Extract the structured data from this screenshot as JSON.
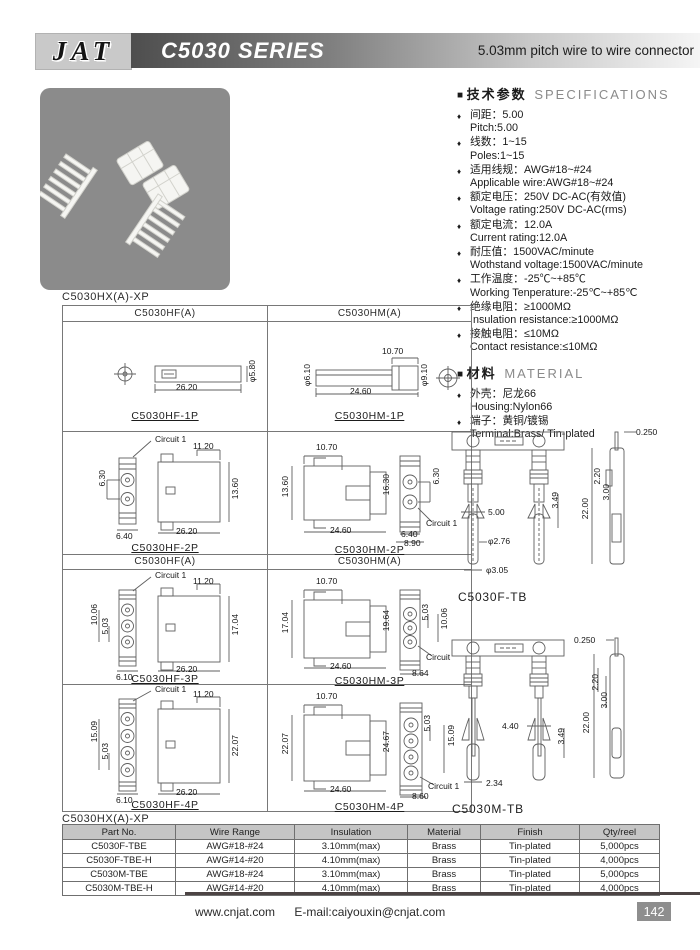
{
  "header": {
    "logo": "JAT",
    "series_title": "C5030 SERIES",
    "subtitle": "5.03mm pitch wire to wire connector"
  },
  "specs": {
    "heading_cn": "技术参数",
    "heading_en": "SPECIFICATIONS",
    "items": [
      {
        "cn": "间距：5.00",
        "en": "Pitch:5.00"
      },
      {
        "cn": "线数：1~15",
        "en": "Poles:1~15"
      },
      {
        "cn": "适用线规：AWG#18~#24",
        "en": "Applicable wire:AWG#18~#24"
      },
      {
        "cn": "额定电压：250V DC-AC(有效值)",
        "en": "Voltage rating:250V DC-AC(rms)"
      },
      {
        "cn": "额定电流：12.0A",
        "en": "Current rating:12.0A"
      },
      {
        "cn": "耐压值：1500VAC/minute",
        "en": "Wothstand voltage:1500VAC/minute"
      },
      {
        "cn": "工作温度：-25℃~+85℃",
        "en": "Working Tenperature:-25℃~+85℃"
      },
      {
        "cn": "绝缘电阻：≥1000MΩ",
        "en": "Insulation resistance:≥1000MΩ"
      },
      {
        "cn": "接触电阻：≤10MΩ",
        "en": "Contact resistance:≤10MΩ"
      }
    ]
  },
  "material": {
    "heading_cn": "材料",
    "heading_en": "MATERIAL",
    "items": [
      {
        "cn": "外壳：尼龙66",
        "en": "Housing:Nylon66"
      },
      {
        "cn": "端子：黄铜/镀锡",
        "en": "Terminal:Brass/ Tin-plated"
      }
    ]
  },
  "drawings": {
    "series_label": "C5030HX(A)-XP",
    "col_headers": [
      "C5030HF(A)",
      "C5030HM(A)"
    ],
    "cells": {
      "hf1p": {
        "label": "C5030HF-1P",
        "dims": {
          "w": "26.20",
          "d": "φ5.80"
        }
      },
      "hm1p": {
        "label": "C5030HM-1P",
        "dims": {
          "t": "10.70",
          "dl": "φ6.10",
          "dr": "φ9.10",
          "w": "24.60"
        }
      },
      "hf2p": {
        "label": "C5030HF-2P",
        "circuit": "Circuit 1",
        "dims": {
          "t": "11.20",
          "p": "6.30",
          "sw": "6.40",
          "h": "13.60",
          "w": "26.20"
        }
      },
      "hm2p": {
        "label": "C5030HM-2P",
        "circuit": "Circuit 1",
        "dims": {
          "t": "10.70",
          "h": "13.60",
          "bh": "16.30",
          "p": "6.30",
          "w": "24.60",
          "s1": "6.40",
          "s2": "8.90"
        }
      },
      "hf3p": {
        "label": "C5030HF-3P",
        "circuit": "Circuit 1",
        "dims": {
          "t": "11.20",
          "p2": "10.06",
          "p": "5.03",
          "sw": "6.10",
          "h": "17.04",
          "w": "26.20"
        }
      },
      "hm3p": {
        "label": "C5030HM-3P",
        "circuit": "Circuit",
        "dims": {
          "t": "10.70",
          "h": "17.04",
          "bh": "19.64",
          "p": "5.03",
          "p2": "10.06",
          "w": "24.60",
          "s": "8.64"
        }
      },
      "hf4p": {
        "label": "C5030HF-4P",
        "circuit": "Circuit 1",
        "dims": {
          "t": "11.20",
          "p2": "15.09",
          "p": "5.03",
          "sw": "6.10",
          "h": "22.07",
          "w": "26.20"
        }
      },
      "hm4p": {
        "label": "C5030HM-4P",
        "circuit": "Circuit 1",
        "dims": {
          "t": "10.70",
          "h": "22.07",
          "bh": "24.67",
          "p": "5.03",
          "p2": "15.09",
          "w": "24.60",
          "s": "8.60"
        }
      }
    },
    "terminals": {
      "f_tb": {
        "label": "C5030F-TB",
        "dims": {
          "tab": "0.250",
          "a": "3.49",
          "b": "5.00",
          "c": "φ2.76",
          "d": "φ3.05",
          "e": "22.00",
          "f": "2.20",
          "g": "3.00"
        }
      },
      "m_tb": {
        "label": "C5030M-TB",
        "dims": {
          "tab": "0.250",
          "a": "4.40",
          "b": "3.49",
          "c": "2.20",
          "d": "3.00",
          "e": "22.00",
          "f": "2.34"
        }
      }
    }
  },
  "table": {
    "headers": [
      "Part No.",
      "Wire Range",
      "Insulation",
      "Material",
      "Finish",
      "Qty/reel"
    ],
    "rows": [
      [
        "C5030F-TBE",
        "AWG#18-#24",
        "3.10mm(max)",
        "Brass",
        "Tin-plated",
        "5,000pcs"
      ],
      [
        "C5030F-TBE-H",
        "AWG#14-#20",
        "4.10mm(max)",
        "Brass",
        "Tin-plated",
        "4,000pcs"
      ],
      [
        "C5030M-TBE",
        "AWG#18-#24",
        "3.10mm(max)",
        "Brass",
        "Tin-plated",
        "5,000pcs"
      ],
      [
        "C5030M-TBE-H",
        "AWG#14-#20",
        "4.10mm(max)",
        "Brass",
        "Tin-plated",
        "4,000pcs"
      ]
    ]
  },
  "footer": {
    "website": "www.cnjat.com",
    "email": "E-mail:caiyouxin@cnjat.com",
    "page_number": "142"
  }
}
